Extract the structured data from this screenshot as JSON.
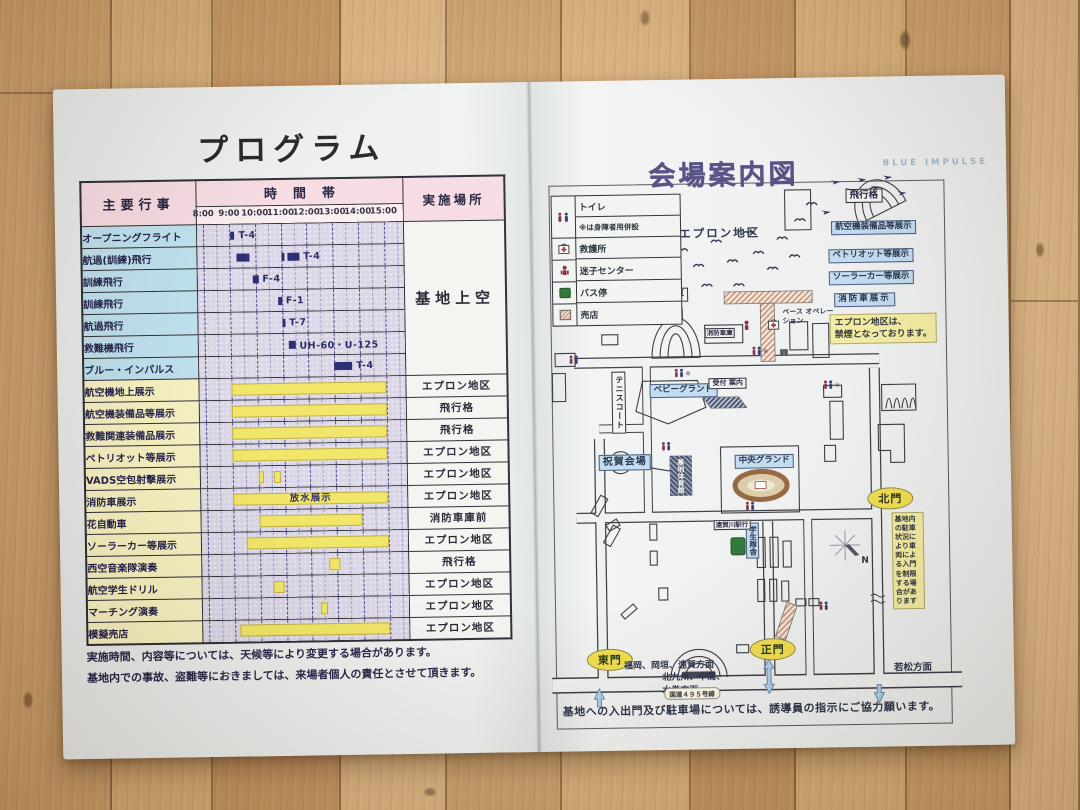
{
  "program": {
    "title": "プログラム",
    "header": {
      "events": "主要行事",
      "time_band": "時間帯",
      "location": "実施場所"
    },
    "times": [
      "8:00",
      "9:00",
      "10:00",
      "11:00",
      "12:00",
      "13:00",
      "14:00",
      "15:00"
    ],
    "merged_location": "基地上空",
    "rows": [
      {
        "label": "オープニングフライト",
        "section": "air",
        "bars": [
          {
            "start": 9.05,
            "end": 9.2,
            "tag": "T-4"
          }
        ]
      },
      {
        "label": "航過(訓練)飛行",
        "section": "air",
        "bars": [
          {
            "start": 9.25,
            "end": 9.75
          },
          {
            "start": 11.0,
            "end": 11.12
          },
          {
            "start": 11.25,
            "end": 11.7,
            "tag": "T-4"
          }
        ]
      },
      {
        "label": "訓練飛行",
        "section": "air",
        "bars": [
          {
            "start": 9.9,
            "end": 10.1,
            "tag": "F-4"
          }
        ]
      },
      {
        "label": "訓練飛行",
        "section": "air",
        "bars": [
          {
            "start": 10.85,
            "end": 11.0,
            "tag": "F-1"
          }
        ]
      },
      {
        "label": "航過飛行",
        "section": "air",
        "bars": [
          {
            "start": 11.0,
            "end": 11.12,
            "tag": "T-7"
          }
        ]
      },
      {
        "label": "救難機飛行",
        "section": "air",
        "bars": [
          {
            "start": 11.25,
            "end": 11.5,
            "tag": "UH-60・U-125"
          }
        ]
      },
      {
        "label": "ブルー・インパルス",
        "section": "air",
        "bars": [
          {
            "start": 13.0,
            "end": 13.7,
            "tag": "T-4"
          }
        ]
      },
      {
        "label": "航空機地上展示",
        "section": "ground",
        "location": "エプロン地区",
        "bars": [
          {
            "start": 9,
            "end": 15
          }
        ]
      },
      {
        "label": "航空機装備品等展示",
        "section": "ground",
        "location": "飛行格",
        "bars": [
          {
            "start": 9,
            "end": 15
          }
        ]
      },
      {
        "label": "救難関連装備品展示",
        "section": "ground",
        "location": "飛行格",
        "bars": [
          {
            "start": 9,
            "end": 15
          }
        ]
      },
      {
        "label": "ペトリオット等展示",
        "section": "ground",
        "location": "エプロン地区",
        "bars": [
          {
            "start": 9,
            "end": 15
          }
        ]
      },
      {
        "label": "VADS空包射撃展示",
        "section": "ground",
        "location": "エプロン地区",
        "bars": [
          {
            "start": 10.0,
            "end": 10.2
          },
          {
            "start": 10.6,
            "end": 10.85
          }
        ]
      },
      {
        "label": "消防車展示",
        "section": "ground",
        "location": "エプロン地区",
        "bars": [
          {
            "start": 9,
            "end": 15,
            "text": "放水展示"
          }
        ]
      },
      {
        "label": "花自動車",
        "section": "ground",
        "location": "消防車庫前",
        "bars": [
          {
            "start": 10,
            "end": 14
          }
        ]
      },
      {
        "label": "ソーラーカー等展示",
        "section": "ground",
        "location": "エプロン地区",
        "bars": [
          {
            "start": 9.5,
            "end": 15
          }
        ]
      },
      {
        "label": "西空音楽隊演奏",
        "section": "ground",
        "location": "飛行格",
        "bars": [
          {
            "start": 12.7,
            "end": 13.1
          }
        ]
      },
      {
        "label": "航空学生ドリル",
        "section": "ground",
        "location": "エプロン地区",
        "bars": [
          {
            "start": 10.5,
            "end": 10.95
          }
        ]
      },
      {
        "label": "マーチング演奏",
        "section": "ground",
        "location": "エプロン地区",
        "bars": [
          {
            "start": 12.35,
            "end": 12.6
          }
        ]
      },
      {
        "label": "模擬売店",
        "section": "ground",
        "location": "エプロン地区",
        "bars": [
          {
            "start": 9.2,
            "end": 15
          }
        ]
      }
    ],
    "notes": [
      "実施時間、内容等については、天候等により変更する場合があります。",
      "基地内での事故、盗難等におきましては、来場者個人の責任とさせて頂きます。"
    ]
  },
  "map": {
    "title": "会場案内図",
    "watermark": "BLUE  IMPULSE",
    "legend": {
      "rows": [
        {
          "icon": "toilet-icon",
          "label": "トイレ"
        },
        {
          "icon": "",
          "label": "※は身障者用併設"
        },
        {
          "icon": "first-aid-icon",
          "label": "救護所"
        },
        {
          "icon": "lost-child-icon",
          "label": "迷子センター"
        },
        {
          "icon": "bus-stop-icon",
          "label": "バス停"
        },
        {
          "icon": "shop-icon",
          "label": "売店"
        }
      ]
    },
    "labels": {
      "apron_area": "エプロン地区",
      "hangar": "飛行格",
      "equipment": "航空機装備品等展示",
      "patriot": "ペトリオット等展示",
      "solar_car": "ソーラーカー等展示",
      "fire_truck": "消防車展示",
      "flower_car": "花自動車",
      "fire_garage": "消防車庫",
      "base_operation": "ベース オペレーション",
      "baby_ground": "ベビーグランド",
      "reception": "受付 案内",
      "tennis_court": "テニスコート",
      "celebration": "祝賀会場",
      "gym": "基地体育館",
      "central_ground": "中央グランド",
      "student_barracks": "学生隊舎",
      "station_bus": "遠賀川駅行"
    },
    "gates": {
      "north": "北門",
      "east": "東門",
      "main": "正門"
    },
    "directions": {
      "east_gate": "福岡、岡垣、遠賀方面",
      "main_gate": "北九州、中間、\n水巻方面",
      "wakamatsu": "若松方面"
    },
    "road": "国道４９５号線",
    "notices": {
      "no_smoking": "エプロン地区は、\n禁煙となっております。",
      "parking": "基地内の駐車状況により車両による入門を制限する場合があります",
      "bottom": "基地への入出門及び駐車場については、誘導員の指示にご協力願います。"
    },
    "compass_n": "N"
  }
}
